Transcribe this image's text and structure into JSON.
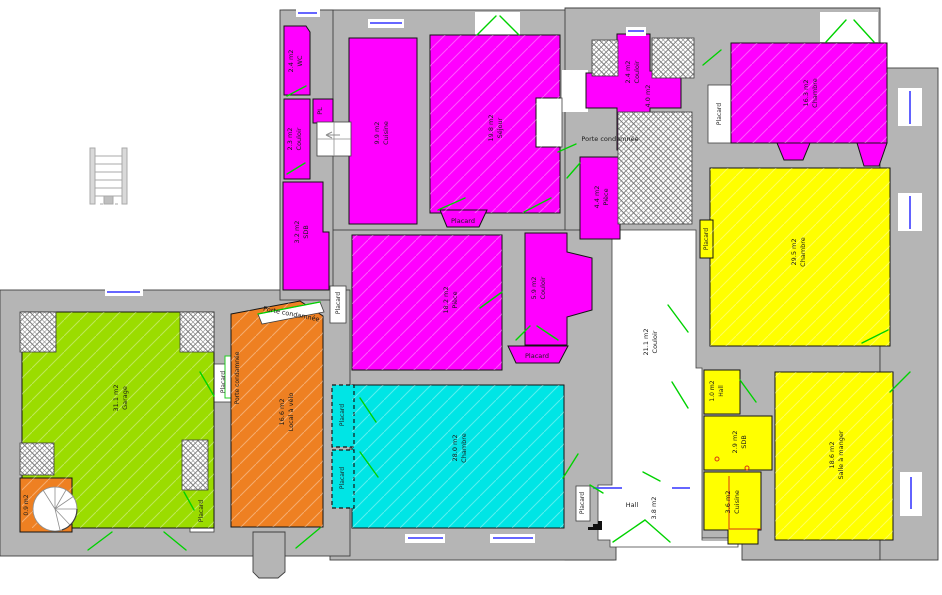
{
  "plan_title": "Floor plan with colored room areas",
  "colors": {
    "magenta": "#FF00FF",
    "yellow": "#FFFF00",
    "cyan": "#00E5E5",
    "green": "#9BDC00",
    "orange": "#EE8022",
    "wall": "#B5B5B5",
    "door": "#00D200",
    "window": "#5050FF",
    "red": "#D93511"
  },
  "labels": {
    "placard": "Placard",
    "porte_condamnee": "Porte condamnée"
  },
  "rooms": {
    "wc": {
      "area": "2.4 m2",
      "name": "WC"
    },
    "pl": {
      "name": "PL"
    },
    "couloir_a": {
      "area": "2.3 m2",
      "name": "Couloir"
    },
    "sdb_a": {
      "area": "3.2 m2",
      "name": "SDB"
    },
    "cuisine_a": {
      "area": "9.9 m2",
      "name": "Cuisine"
    },
    "sejour": {
      "area": "19.8 m2",
      "name": "Séjour"
    },
    "couloir_b": {
      "area": "2.4 m2",
      "name": "Couloir"
    },
    "piece_40": {
      "area": "4.0 m2"
    },
    "piece_44": {
      "area": "4.4 m2",
      "name": "Pièce"
    },
    "chambre_ne": {
      "area": "16.3 m2",
      "name": "Chambre"
    },
    "chambre_e": {
      "area": "29.5 m2",
      "name": "Chambre"
    },
    "hall_1": {
      "area": "1.0 m2",
      "name": "Hall"
    },
    "sdb_b": {
      "area": "2.9 m2",
      "name": "SDB"
    },
    "cuisine_b": {
      "area": "3.6 m2",
      "name": "Cuisine"
    },
    "salle_a_manger": {
      "area": "18.6 m2",
      "name": "Salle à manger"
    },
    "couloir_c": {
      "area": "21.1 m2",
      "name": "Couloir"
    },
    "hall_38": {
      "area": "3.8 m2",
      "name": "Hall"
    },
    "piece_18": {
      "area": "18.2 m2",
      "name": "Pièce"
    },
    "couloir_d": {
      "area": "5.9 m2",
      "name": "Couloir"
    },
    "chambre_s": {
      "area": "28.0 m2",
      "name": "Chambre"
    },
    "garage": {
      "area": "31.1 m2",
      "name": "Garage"
    },
    "local_velo": {
      "area": "16.6 m2",
      "name": "Local à vélo"
    },
    "escalier": {
      "area": "0.9 m2"
    }
  }
}
